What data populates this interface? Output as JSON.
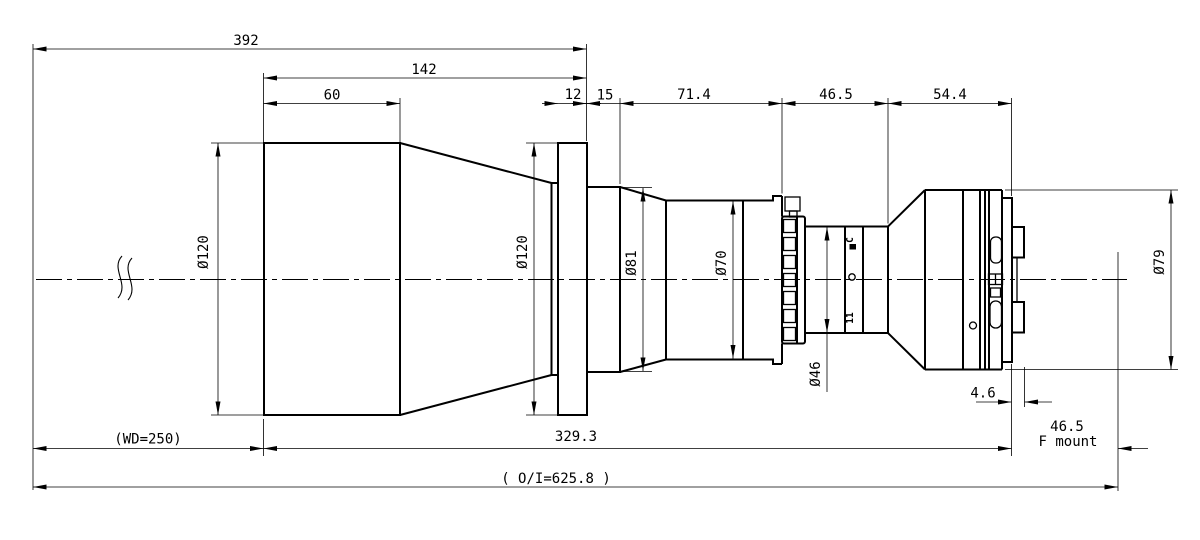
{
  "drawing": {
    "title": "telecentric-lens-outline-drawing",
    "colors": {
      "ink": "#000000",
      "background": "#ffffff"
    },
    "dims_top": {
      "overall": "392",
      "front_to_flange": "142",
      "hood": "60",
      "flange_width": "12",
      "step": "15",
      "mid_barrel": "71.4",
      "iris_section": "46.5",
      "rear_section": "54.4"
    },
    "dims_bottom": {
      "working_distance": "(WD=250)",
      "body_length": "329.3",
      "bayonet_depth": "4.6",
      "flange_focal": "46.5",
      "mount": "F mount",
      "object_image": "( O/I=625.8 )"
    },
    "diameters": {
      "front_barrel": "Ø120",
      "flange": "Ø120",
      "mid": "Ø81",
      "barrel": "Ø70",
      "iris_neck": "Ø46",
      "rear": "Ø79"
    },
    "aperture_ring": {
      "closed_mark": "C",
      "fstop_mark": "11"
    }
  }
}
